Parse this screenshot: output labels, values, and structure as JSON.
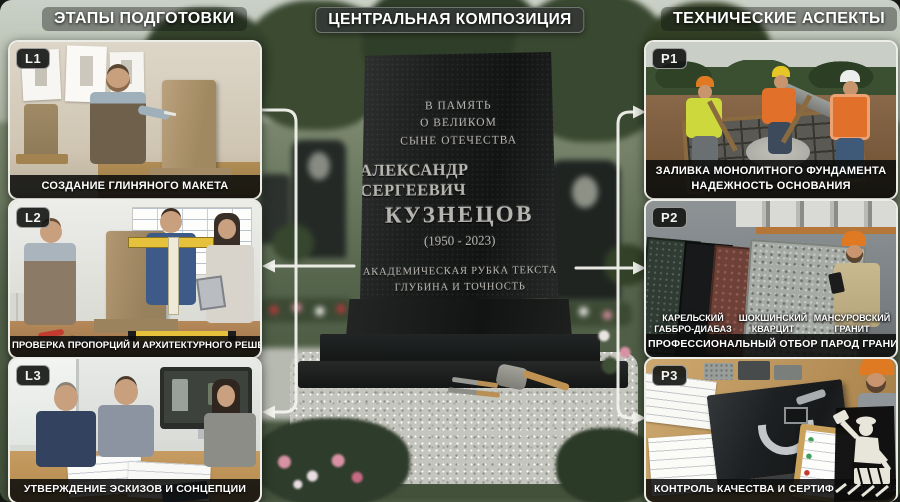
{
  "headers": {
    "left": "ЭТАПЫ ПОДГОТОВКИ",
    "center": "ЦЕНТРАЛЬНАЯ КОМПОЗИЦИЯ",
    "right": "ТЕХНИЧЕСКИЕ АСПЕКТЫ"
  },
  "left_panels": [
    {
      "badge": "L1",
      "caption": "СОЗДАНИЕ ГЛИНЯНОГО МАКЕТА"
    },
    {
      "badge": "L2",
      "caption": "ПРОВЕРКА ПРОПОРЦИЙ И АРХИТЕКТУРНОГО РЕШЕНИЯ"
    },
    {
      "badge": "L3",
      "caption": "УТВЕРЖДЕНИЕ ЭСКИЗОВ И СОНЦЕПЦИИ"
    }
  ],
  "right_panels": [
    {
      "badge": "P1",
      "caption": "ЗАЛИВКА МОНОЛИТНОГО ФУНДАМЕНТА",
      "caption2": "НАДЕЖНОСТЬ ОСНОВАНИЯ"
    },
    {
      "badge": "P2",
      "caption": "ПРОФЕССИОНАЛЬНЫЙ ОТБОР ПАРОД ГРАНИТА",
      "stones": [
        {
          "line1": "КАРЕЛЬСКИЙ",
          "line2": "ГАББРО-ДИАБАЗ"
        },
        {
          "line1": "ШОКШИНСКИЙ",
          "line2": "КВАРЦИТ"
        },
        {
          "line1": "МАНСУРОВСКИЙ",
          "line2": "ГРАНИТ"
        }
      ]
    },
    {
      "badge": "P3",
      "caption": "КОНТРОЛЬ КАЧЕСТВА И СЕРТИФИКАЦИЯ МАТ"
    }
  ],
  "monument": {
    "memory1": "В ПАМЯТЬ",
    "memory2": "О ВЕЛИКОМ",
    "memory3": "СЫНЕ ОТЕЧЕСТВА",
    "name_first": "АЛЕКСАНДР СЕРГЕЕВИЧ",
    "name_last": "КУЗНЕЦОВ",
    "years": "(1950 - 2023)",
    "note1": "АКАДЕМИЧЕСКАЯ РУБКА ТЕКСТА",
    "note2": "ГЛУБИНА И ТОЧНОСТЬ"
  },
  "icons": {
    "watermark": "stonemason-logo"
  },
  "colors": {
    "arrow": "#f3f3ee",
    "caption_bg": "#0c0e0c",
    "granite_black": "#17191a",
    "clay_tan": "#ab9270",
    "hivis_orange": "#e0702a",
    "caliper_yellow": "#e6c23c"
  }
}
